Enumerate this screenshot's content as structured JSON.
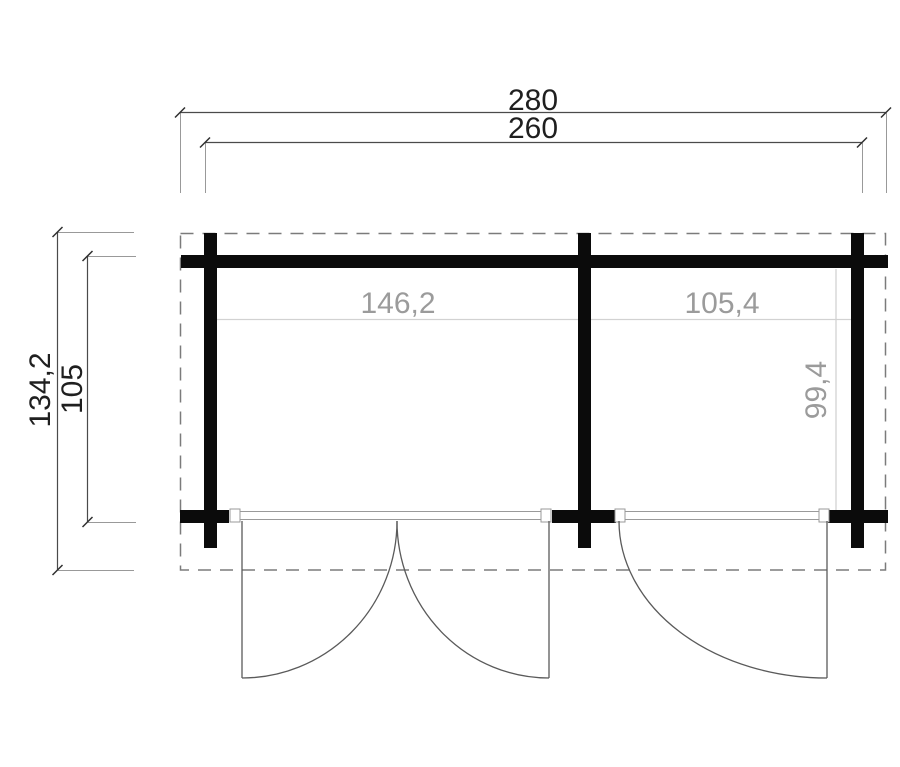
{
  "drawing": {
    "type": "floor-plan",
    "labels": {
      "overall_width": "280",
      "shell_width": "260",
      "overall_depth": "134,2",
      "shell_depth": "105",
      "left_room_width": "146,2",
      "right_room_width": "105,4",
      "right_room_depth": "99,4"
    },
    "colors": {
      "background": "#ffffff",
      "wall": "#0b0b0b",
      "dimension_line": "#4a4a4a",
      "tick": "#2f2f2f",
      "extension_line": "#999999",
      "dimension_text": "#1f1f1f",
      "interior_text": "#9b9b9b",
      "interior_line": "#d2d2d2",
      "roof_dash": "#7b7b7b",
      "door_line": "#5a5a5a",
      "sill_border": "#9a9a9a"
    }
  }
}
